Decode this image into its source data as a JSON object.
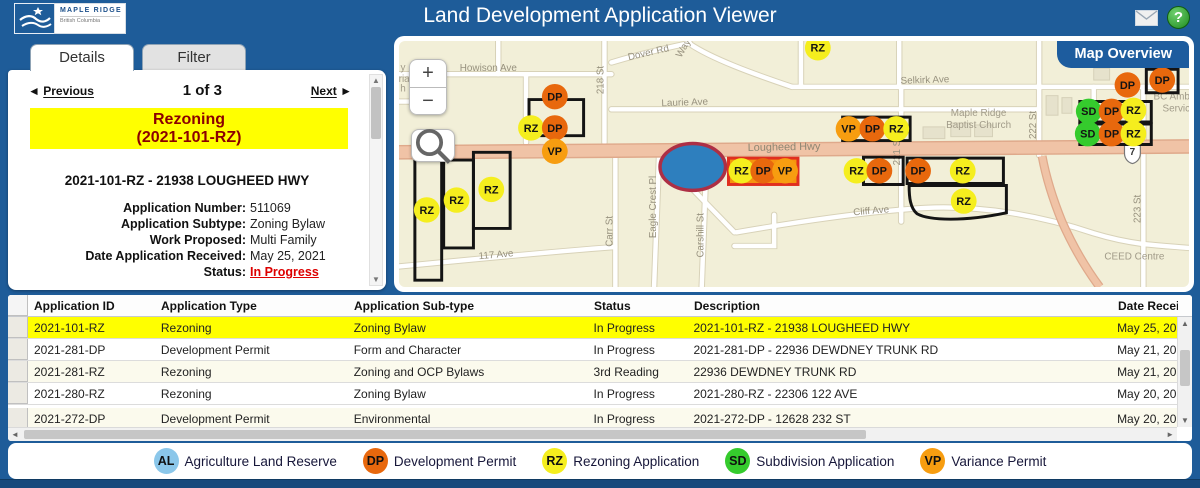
{
  "header": {
    "logo_title": "MAPLE RIDGE",
    "logo_subtitle": "British Columbia",
    "title": "Land Development Application Viewer",
    "help_glyph": "?"
  },
  "colors": {
    "header_blue": "#1e5c99",
    "highlight_yellow": "#ffff00",
    "status_red": "#dd0000",
    "banner_text_red": "#8b0000"
  },
  "details_panel": {
    "tabs": [
      {
        "label": "Details",
        "active": true
      },
      {
        "label": "Filter",
        "active": false
      }
    ],
    "nav": {
      "prev_icon": "◄",
      "previous": "Previous",
      "counter": "1 of 3",
      "next": "Next",
      "next_icon": "►"
    },
    "banner_title": "Rezoning",
    "banner_id": "(2021-101-RZ)",
    "address": "2021-101-RZ - 21938 LOUGHEED HWY",
    "fields": [
      {
        "label": "Application Number:",
        "value": "511069"
      },
      {
        "label": "Application Subtype:",
        "value": "Zoning Bylaw"
      },
      {
        "label": "Work Proposed:",
        "value": "Multi Family"
      },
      {
        "label": "Date Application Received:",
        "value": "May 25, 2021"
      },
      {
        "label": "Status:",
        "value": "In Progress",
        "status": true
      }
    ]
  },
  "ui": {
    "scroll_up": "▲",
    "scroll_down": "▼",
    "scroll_left": "◄",
    "scroll_right": "►"
  },
  "map": {
    "overview_button": "Map Overview",
    "controls": {
      "zoom_in": "+",
      "zoom_out": "−"
    },
    "highway_shield": "7",
    "streets": [
      {
        "t": "Howison Ave",
        "x": 90,
        "y": 31,
        "r": 0
      },
      {
        "t": "Dover Rd",
        "x": 252,
        "y": 15,
        "r": -13
      },
      {
        "t": "Way",
        "x": 289,
        "y": 9,
        "r": -60
      },
      {
        "t": "218 St",
        "x": 206,
        "y": 40,
        "r": -90
      },
      {
        "t": "Laurie Ave",
        "x": 288,
        "y": 66,
        "r": -2
      },
      {
        "t": "Selkirk Ave",
        "x": 530,
        "y": 43,
        "r": -2
      },
      {
        "t": "Lougheed Hwy",
        "x": 388,
        "y": 112,
        "r": -1,
        "cls": "hwy"
      },
      {
        "t": "221 St",
        "x": 505,
        "y": 113,
        "r": -90
      },
      {
        "t": "222 St",
        "x": 642,
        "y": 86,
        "r": -90
      },
      {
        "t": "223 St",
        "x": 747,
        "y": 172,
        "r": -90
      },
      {
        "t": "Carr St",
        "x": 215,
        "y": 195,
        "r": -90
      },
      {
        "t": "Eagle Crest Pl",
        "x": 259,
        "y": 170,
        "r": -90
      },
      {
        "t": "Carshill St",
        "x": 307,
        "y": 199,
        "r": -90
      },
      {
        "t": "Cliff Ave",
        "x": 476,
        "y": 177,
        "r": -5
      },
      {
        "t": "117 Ave",
        "x": 98,
        "y": 222,
        "r": -5
      }
    ],
    "pois": [
      {
        "t": "Maple Ridge",
        "x": 584,
        "y": 77
      },
      {
        "t": "Baptist Church",
        "x": 584,
        "y": 89
      },
      {
        "t": "BC Ambulan",
        "x": 788,
        "y": 60
      },
      {
        "t": "Service",
        "x": 786,
        "y": 72
      },
      {
        "t": "CEED Centre",
        "x": 741,
        "y": 224
      },
      {
        "t": "y",
        "x": 4,
        "y": 30
      },
      {
        "t": "rian",
        "x": 8,
        "y": 42
      },
      {
        "t": "h",
        "x": 4,
        "y": 52
      }
    ],
    "marker_colors": {
      "DP": "#e8680d",
      "RZ": "#f5ee1e",
      "VP": "#f79d10",
      "SD": "#35cb2d",
      "AL": "#8bc7ea"
    },
    "markers": [
      {
        "t": "RZ",
        "x": 422,
        "y": 7
      },
      {
        "t": "DP",
        "x": 157,
        "y": 57
      },
      {
        "t": "RZ",
        "x": 133,
        "y": 89
      },
      {
        "t": "DP",
        "x": 157,
        "y": 89
      },
      {
        "t": "VP",
        "x": 157,
        "y": 113
      },
      {
        "t": "RZ",
        "x": 93,
        "y": 152
      },
      {
        "t": "RZ",
        "x": 58,
        "y": 163
      },
      {
        "t": "RZ",
        "x": 28,
        "y": 173
      },
      {
        "t": "RZ",
        "x": 345,
        "y": 133
      },
      {
        "t": "DP",
        "x": 367,
        "y": 133
      },
      {
        "t": "VP",
        "x": 389,
        "y": 133
      },
      {
        "t": "VP",
        "x": 453,
        "y": 90
      },
      {
        "t": "DP",
        "x": 477,
        "y": 90
      },
      {
        "t": "RZ",
        "x": 501,
        "y": 90
      },
      {
        "t": "RZ",
        "x": 461,
        "y": 133
      },
      {
        "t": "DP",
        "x": 484,
        "y": 133
      },
      {
        "t": "DP",
        "x": 523,
        "y": 133
      },
      {
        "t": "RZ",
        "x": 568,
        "y": 133
      },
      {
        "t": "RZ",
        "x": 569,
        "y": 164
      },
      {
        "t": "DP",
        "x": 734,
        "y": 45
      },
      {
        "t": "DP",
        "x": 769,
        "y": 40
      },
      {
        "t": "SD",
        "x": 695,
        "y": 72
      },
      {
        "t": "DP",
        "x": 718,
        "y": 72
      },
      {
        "t": "RZ",
        "x": 740,
        "y": 71
      },
      {
        "t": "SD",
        "x": 694,
        "y": 95
      },
      {
        "t": "DP",
        "x": 718,
        "y": 95
      },
      {
        "t": "RZ",
        "x": 740,
        "y": 95
      }
    ],
    "selected_parcel_ellipse": {
      "cx": 296,
      "cy": 129,
      "rx": 33,
      "ry": 24
    }
  },
  "table": {
    "columns": [
      "Application ID",
      "Application Type",
      "Application Sub-type",
      "Status",
      "Description",
      "Date Received"
    ],
    "rows": [
      {
        "cells": [
          "2021-101-RZ",
          "Rezoning",
          "Zoning Bylaw",
          "In Progress",
          "2021-101-RZ - 21938 LOUGHEED HWY",
          "May 25, 2021"
        ],
        "selected": true
      },
      {
        "cells": [
          "2021-281-DP",
          "Development Permit",
          "Form and Character",
          "In Progress",
          "2021-281-DP - 22936 DEWDNEY TRUNK RD",
          "May 21, 2021"
        ]
      },
      {
        "cells": [
          "2021-281-RZ",
          "Rezoning",
          "Zoning and OCP Bylaws",
          "3rd Reading",
          "22936 DEWDNEY TRUNK RD",
          "May 21, 2021"
        ]
      },
      {
        "cells": [
          "2021-280-RZ",
          "Rezoning",
          "Zoning Bylaw",
          "In Progress",
          "2021-280-RZ - 22306 122 AVE",
          "May 20, 2021"
        ]
      },
      {
        "cells": [
          "2021-272-DP",
          "Development Permit",
          "Environmental",
          "In Progress",
          "2021-272-DP - 12628 232 ST",
          "May 20, 2021"
        ]
      }
    ]
  },
  "legend": {
    "items": [
      {
        "code": "AL",
        "label": "Agriculture Land Reserve",
        "color": "#8bc7ea"
      },
      {
        "code": "DP",
        "label": "Development Permit",
        "color": "#e8680d"
      },
      {
        "code": "RZ",
        "label": "Rezoning Application",
        "color": "#f5ee1e"
      },
      {
        "code": "SD",
        "label": "Subdivision Application",
        "color": "#35cb2d"
      },
      {
        "code": "VP",
        "label": "Variance Permit",
        "color": "#f79d10"
      }
    ]
  }
}
